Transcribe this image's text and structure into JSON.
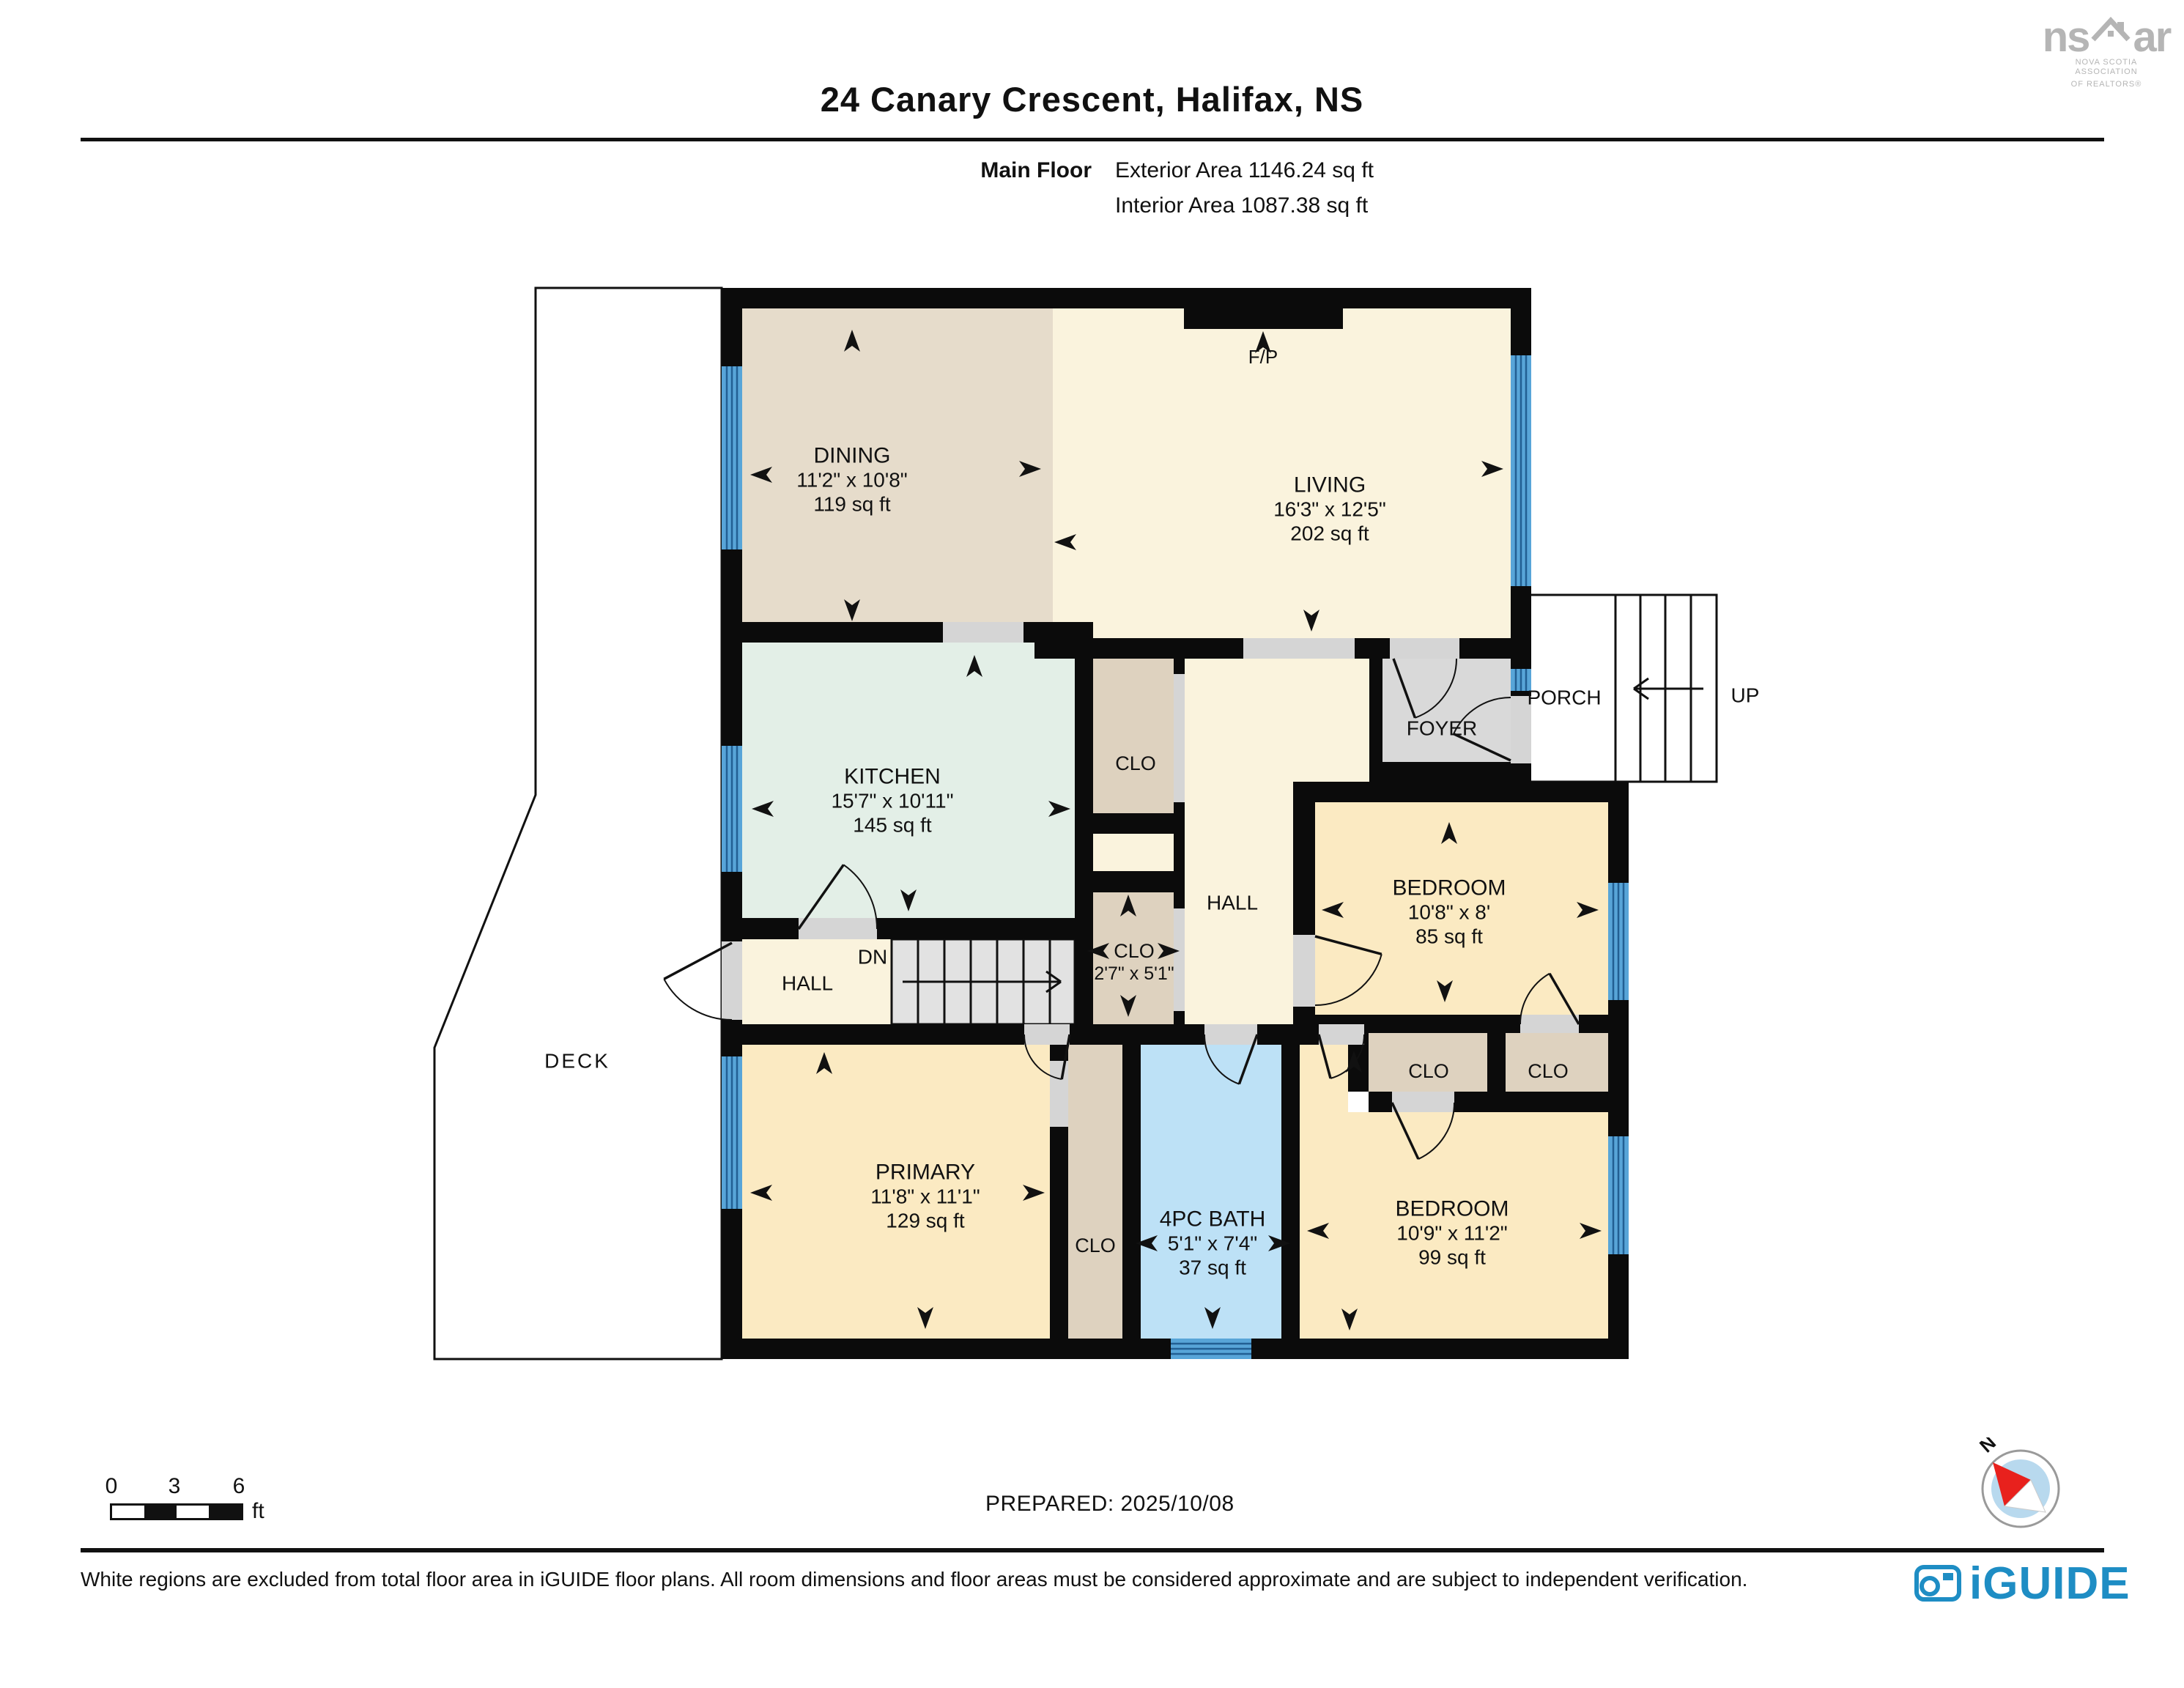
{
  "header": {
    "title": "24 Canary Crescent, Halifax, NS",
    "floor_label": "Main Floor",
    "exterior_area": "Exterior Area 1146.24 sq ft",
    "interior_area": "Interior Area 1087.38 sq ft"
  },
  "branding": {
    "nsar_left": "ns",
    "nsar_right": "ar",
    "nsar_line1": "NOVA SCOTIA ASSOCIATION",
    "nsar_line2": "OF REALTORS®",
    "iguide": "iGUIDE",
    "iguide_color": "#1e8dc4",
    "nsar_color": "#b5b5b5"
  },
  "footer": {
    "prepared": "PREPARED: 2025/10/08",
    "disclaimer": "White regions are excluded from total floor area in iGUIDE floor plans. All room dimensions and floor areas must be considered approximate and are subject to independent verification.",
    "scale": {
      "t0": "0",
      "t3": "3",
      "t6": "6",
      "unit": "ft"
    },
    "compass_north": "N"
  },
  "colors": {
    "wall": "#0b0b0b",
    "dining": "#e6dccb",
    "cream": "#faf3dd",
    "mint": "#e3efe7",
    "yellow": "#fbeac2",
    "bathblue": "#bde1f6",
    "gray": "#d9d9d9",
    "closet": "#ded2bf",
    "opening": "#d5d5d5",
    "window_fill": "#58a5d8",
    "window_stripe": "#225f93",
    "stair": "#e2e2e2",
    "compass_red": "#e8211d",
    "compass_blue": "#b8d9ee"
  },
  "rooms": {
    "dining": [
      "DINING",
      "11'2\" x 10'8\"",
      "119 sq ft"
    ],
    "living": [
      "LIVING",
      "16'3\" x 12'5\"",
      "202 sq ft"
    ],
    "kitchen": [
      "KITCHEN",
      "15'7\" x 10'11\"",
      "145 sq ft"
    ],
    "primary": [
      "PRIMARY",
      "11'8\" x 11'1\"",
      "129 sq ft"
    ],
    "bath": [
      "4PC BATH",
      "5'1\" x 7'4\"",
      "37 sq ft"
    ],
    "bedroom1": [
      "BEDROOM",
      "10'8\" x 8'",
      "85 sq ft"
    ],
    "bedroom2": [
      "BEDROOM",
      "10'9\" x 11'2\"",
      "99 sq ft"
    ],
    "clo_lower": [
      "CLO",
      "2'7\" x 5'1\""
    ],
    "clo_upper": [
      "CLO"
    ],
    "clo_strip": [
      "CLO"
    ],
    "clo_a": [
      "CLO"
    ],
    "clo_b": [
      "CLO"
    ],
    "hall_upper": [
      "HALL"
    ],
    "hall_lower": [
      "HALL"
    ],
    "foyer": [
      "FOYER"
    ],
    "porch": [
      "PORCH"
    ],
    "deck": [
      "DECK"
    ],
    "fp": [
      "F/P"
    ],
    "up": [
      "UP"
    ],
    "dn": [
      "DN"
    ]
  }
}
